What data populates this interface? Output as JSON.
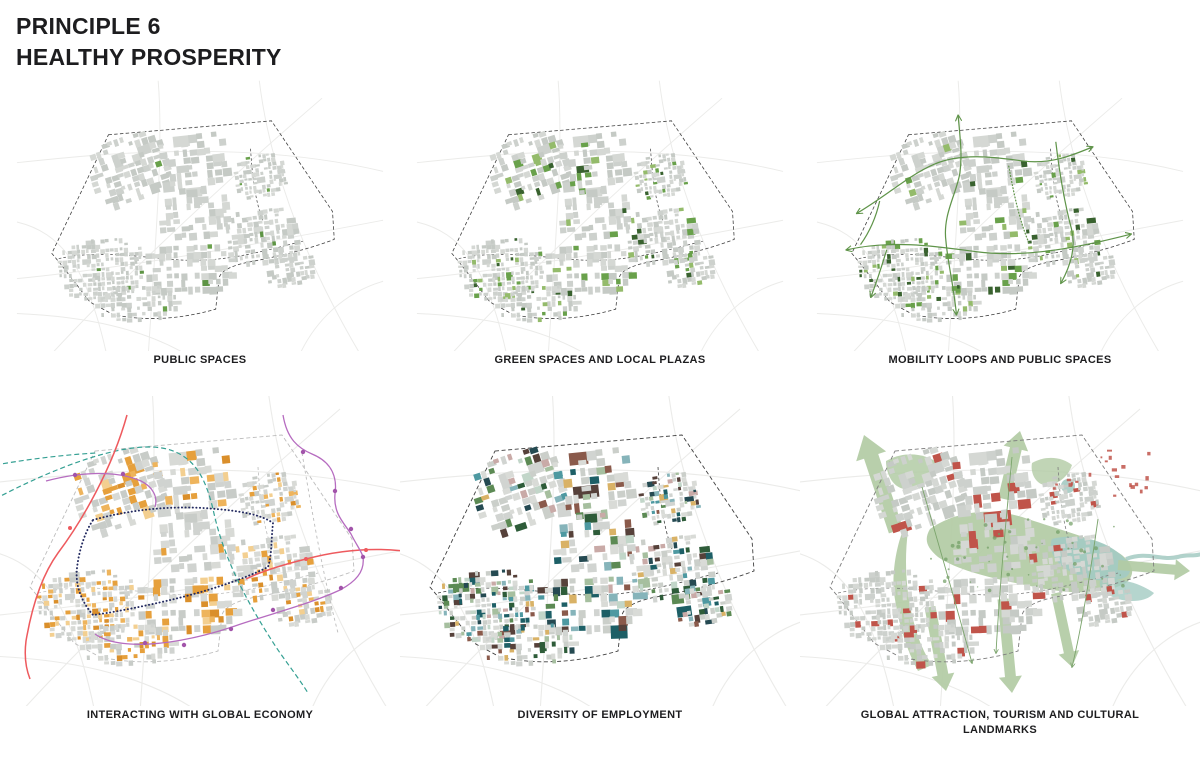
{
  "page": {
    "title_line1": "PRINCIPLE 6",
    "title_line2": "HEALTHY PROSPERITY",
    "background": "#ffffff",
    "text_color": "#1d1d1f"
  },
  "maps": [
    {
      "id": "public-spaces",
      "caption": "PUBLIC SPACES",
      "block_grays": [
        "#d5d8d4",
        "#cdd1cd",
        "#c5cac5"
      ],
      "boundary_color": "#3f3f3f",
      "road_color": "#ebebe9",
      "highlight": {
        "probability": 0.022,
        "colors": [
          "#69a14b",
          "#5d9444"
        ]
      }
    },
    {
      "id": "green-plazas",
      "caption": "GREEN SPACES AND LOCAL PLAZAS",
      "block_grays": [
        "#d5d8d4",
        "#cdd1cd",
        "#c5cac5"
      ],
      "boundary_color": "#3f3f3f",
      "road_color": "#ebebe9",
      "highlight": {
        "probability": 0.14,
        "colors": [
          "#94bb6b",
          "#69a14b",
          "#69a14b",
          "#39622f"
        ]
      }
    },
    {
      "id": "mobility-loops",
      "caption": "MOBILITY LOOPS AND PUBLIC SPACES",
      "block_grays": [
        "#d5d8d4",
        "#cdd1cd",
        "#c5cac5"
      ],
      "boundary_color": "#3f3f3f",
      "road_color": "#ebebe9",
      "highlight": {
        "probability": 0.12,
        "colors": [
          "#94bb6b",
          "#69a14b",
          "#39622f"
        ]
      },
      "overlay": "mobility",
      "overlay_colors": {
        "loop": "#5f9449"
      }
    },
    {
      "id": "global-economy",
      "caption": "INTERACTING WITH GLOBAL ECONOMY",
      "block_grays": [
        "#d8dad6",
        "#d0d3d0",
        "#c8ccc8"
      ],
      "boundary_color": "#bdbdbd",
      "road_color": "#ebebe9",
      "highlight": {
        "probability": 0.34,
        "colors": [
          "#f3cf90",
          "#eeb45c",
          "#e6a03c",
          "#e6a03c",
          "#da8f2b"
        ]
      },
      "overlay": "economy",
      "overlay_colors": {
        "highway": "#ee5a5e",
        "rail": "#35a093",
        "metro": "#b66cc0",
        "metro_dot": "#a254aa",
        "loop": "#232a60",
        "road": "#bdbdbd"
      }
    },
    {
      "id": "employment",
      "caption": "DIVERSITY OF EMPLOYMENT",
      "block_grays": [
        "#d9dbd7",
        "#d1d4d1",
        "#cbcfca"
      ],
      "boundary_color": "#3f3f3f",
      "road_color": "#ebebe9",
      "highlight": {
        "probability": 0.52,
        "colors": [
          "#4e99a1",
          "#1d5f66",
          "#5c8a54",
          "#2e5c39",
          "#a6bf9f",
          "#c9aaa7",
          "#8a5a4b",
          "#56413a",
          "#d9b266",
          "#254a52",
          "#86b4ba",
          "#c2d6c9"
        ]
      }
    },
    {
      "id": "tourism",
      "caption": "GLOBAL ATTRACTION, TOURISM AND CULTURAL LANDMARKS",
      "block_grays": [
        "#d5d8d4",
        "#cdd1cd",
        "#c5cac5"
      ],
      "boundary_color": "#7d7d7d",
      "road_color": "#ebebe9",
      "highlight": {
        "probability": 0.06,
        "colors": [
          "#c0544a"
        ]
      },
      "overlay": "landscape",
      "overlay_colors": {
        "green": "#b2cba4",
        "green_dark": "#6f9c62",
        "water": "#a3cac2",
        "landmark": "#c0544a",
        "line": "#7ba46c"
      }
    }
  ]
}
